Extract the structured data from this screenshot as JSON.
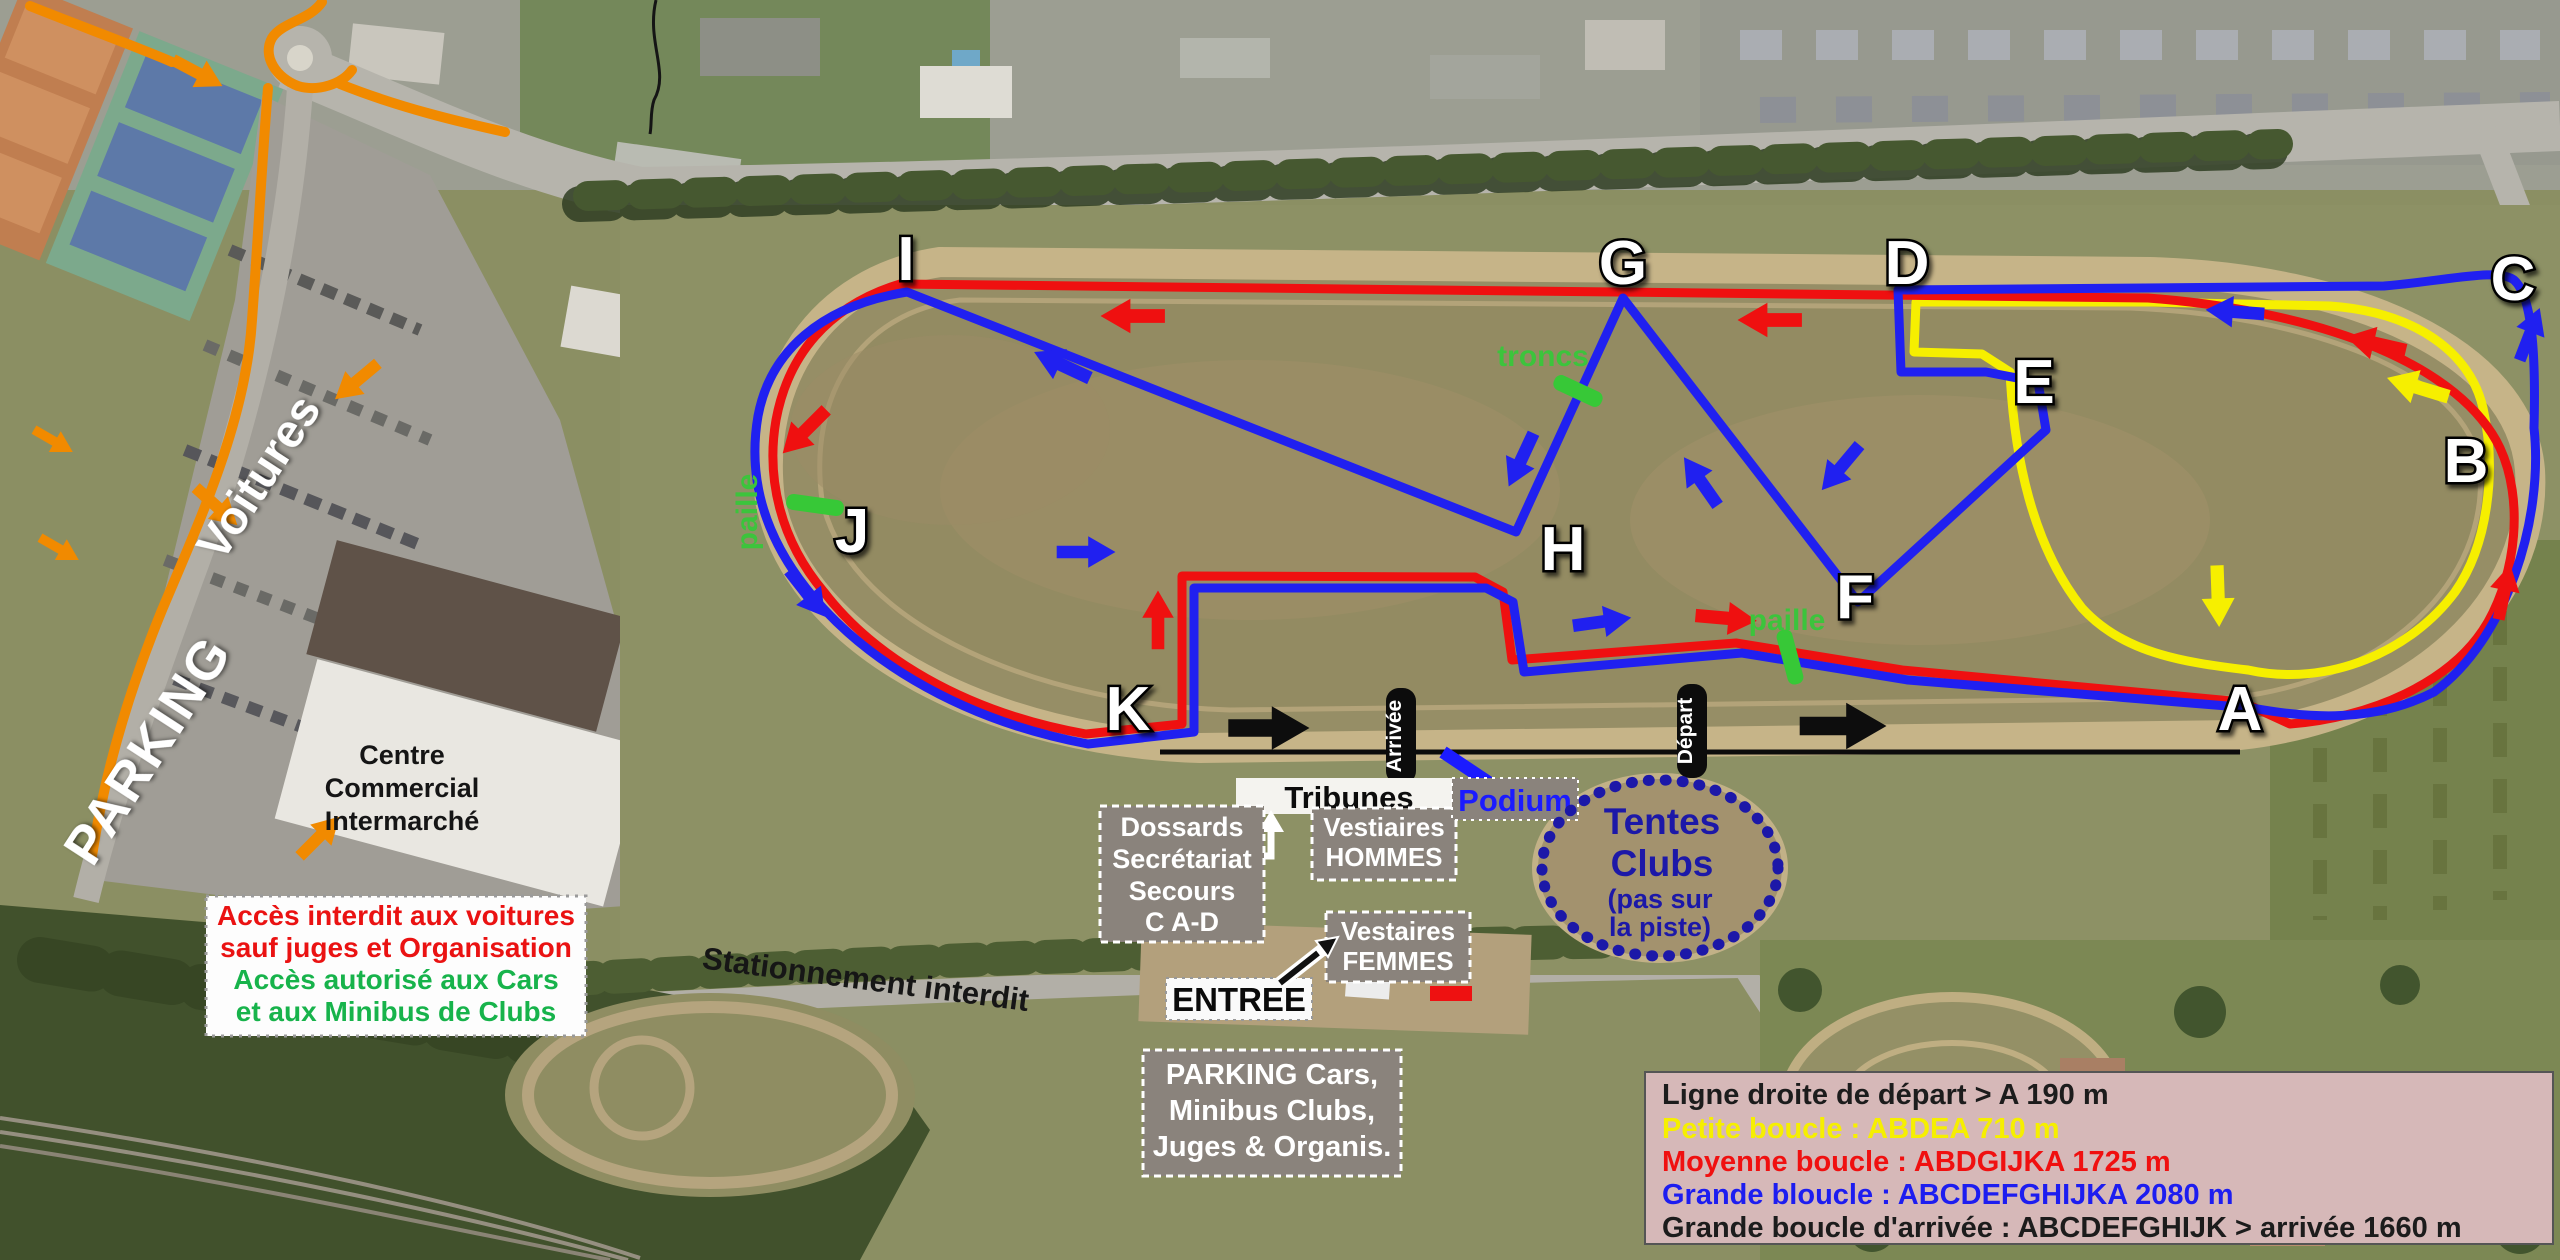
{
  "course_letters": [
    {
      "label": "A"
    },
    {
      "label": "B"
    },
    {
      "label": "C"
    },
    {
      "label": "D"
    },
    {
      "label": "E"
    },
    {
      "label": "F"
    },
    {
      "label": "G"
    },
    {
      "label": "H"
    },
    {
      "label": "I"
    },
    {
      "label": "J"
    },
    {
      "label": "K"
    }
  ],
  "legend": {
    "lines": [
      {
        "text": "Ligne droite de départ  > A 190 m",
        "color": "#1c1c1c"
      },
      {
        "text": "Petite boucle : ABDEA  710 m",
        "color": "#f6ef00"
      },
      {
        "text": "Moyenne boucle : ABDGIJKA  1725 m",
        "color": "#f01010"
      },
      {
        "text": "Grande bloucle : ABCDEFGHIJKA  2080 m",
        "color": "#1d1df0"
      },
      {
        "text": "Grande boucle d'arrivée : ABCDEFGHIJK > arrivée 1660 m",
        "color": "#1c1c1c"
      }
    ]
  },
  "access_box": {
    "lines": [
      {
        "text": "Accès interdit aux voitures",
        "color": "#ea1212"
      },
      {
        "text": "sauf juges et Organisation",
        "color": "#ea1212"
      },
      {
        "text": "Accès autorisé aux Cars",
        "color": "#17b34b"
      },
      {
        "text": "et aux Minibus de Clubs",
        "color": "#17b34b"
      }
    ]
  },
  "mall": {
    "lines": [
      "Centre",
      "Commercial",
      "Intermarché"
    ]
  },
  "parking_area": {
    "title": "PARKING",
    "subtitle": "Voitures"
  },
  "road_label": "Stationnement interdit",
  "entrance": {
    "label": "ENTREE"
  },
  "tribunes": {
    "label": "Tribunes"
  },
  "podium": {
    "label": "Podium"
  },
  "info_boxes": {
    "dossards": {
      "lines": [
        "Dossards",
        "Secrétariat",
        "Secours",
        "C A-D"
      ]
    },
    "vestiaires_hommes": {
      "lines": [
        "Vestiaires",
        "HOMMES"
      ]
    },
    "vestiaires_femmes": {
      "lines": [
        "Vestaires",
        "FEMMES"
      ]
    },
    "parking_cars": {
      "lines": [
        "PARKING Cars,",
        "Minibus Clubs,",
        "Juges & Organis."
      ]
    }
  },
  "tentes": {
    "lines": [
      "Tentes",
      "Clubs",
      "(pas sur",
      "la piste)"
    ]
  },
  "course_markers": {
    "troncs": "troncs",
    "paille_west": "paille",
    "paille_east": "paille",
    "arrivee": "Arrivée",
    "depart": "Départ"
  },
  "colors": {
    "petite_boucle": "#f6ef00",
    "moyenne_boucle": "#ef1010",
    "grande_boucle": "#2020f0",
    "acces_route": "#f18a00",
    "tentes_navy": "#1c18a8",
    "podium_blue": "#1b1bff",
    "legend_bg": "#d6b8b8"
  }
}
